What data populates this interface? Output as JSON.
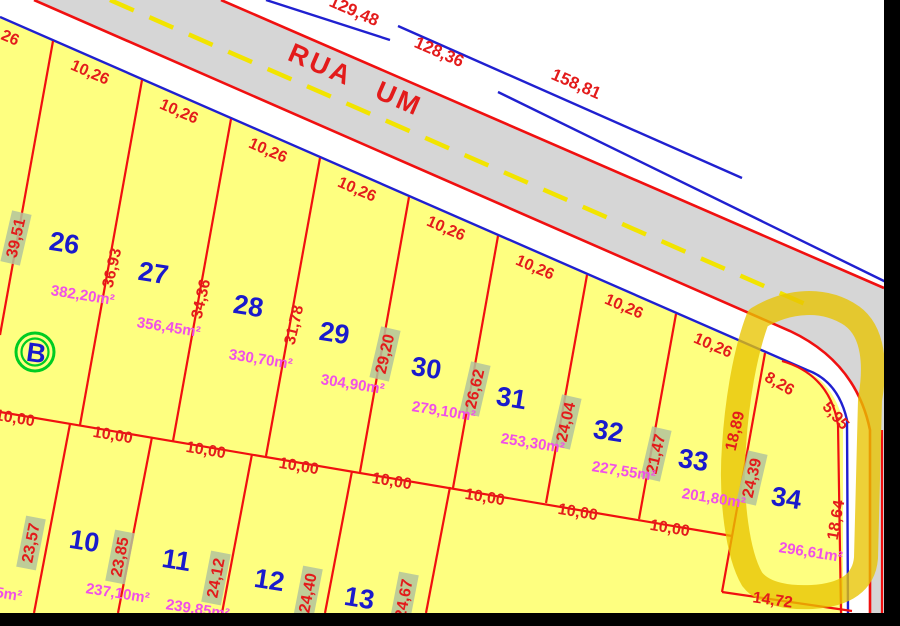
{
  "map": {
    "street_name": "RUA UM",
    "overall_dimensions": [
      "129,48",
      "128,36",
      "158,81"
    ],
    "block_label": "B",
    "frontage_dim": "10,26",
    "rear_dim": "10,00",
    "edge_fragment_area": "5m²",
    "colors": {
      "lot_fill": "#feff80",
      "road_fill": "#d6d6d6",
      "line_red": "#f01010",
      "line_blue": "#2020d0",
      "area_text": "#f050e8",
      "number_text": "#1a1acc",
      "highlight_marker": "#e8c400",
      "dim_highlight_box": "#b3c49c",
      "center_dash": "#f2e400",
      "block_circle_green": "#00cc22"
    },
    "lots_top": [
      {
        "number": "26",
        "left_side": "39,51",
        "area": "382,20m²"
      },
      {
        "number": "27",
        "left_side": "36,93",
        "area": "356,45m²"
      },
      {
        "number": "28",
        "left_side": "34,36",
        "area": "330,70m²"
      },
      {
        "number": "29",
        "left_side": "31,78",
        "area": "304,90m²"
      },
      {
        "number": "30",
        "left_side": "29,20",
        "area": "279,10m²"
      },
      {
        "number": "31",
        "left_side": "26,62",
        "area": "253,30m²"
      },
      {
        "number": "32",
        "left_side": "24,04",
        "area": "227,55m²"
      },
      {
        "number": "33",
        "left_side": "21,47",
        "area": "201,80m²"
      }
    ],
    "lot34": {
      "number": "34",
      "area": "296,61m²",
      "frontage": "8,26",
      "corner": "5,95",
      "right_side": "18,64",
      "left_side": "24,39",
      "adjacent_side": "18,89",
      "bottom": "14,72"
    },
    "lots_bottom": [
      {
        "number": "10",
        "area": "237,10m²"
      },
      {
        "number": "11",
        "area": "239,85m²"
      },
      {
        "number": "12"
      },
      {
        "number": "13"
      }
    ],
    "bottom_side_dims": [
      "23,57",
      "23,85",
      "24,12",
      "24,40",
      "24,67"
    ]
  }
}
